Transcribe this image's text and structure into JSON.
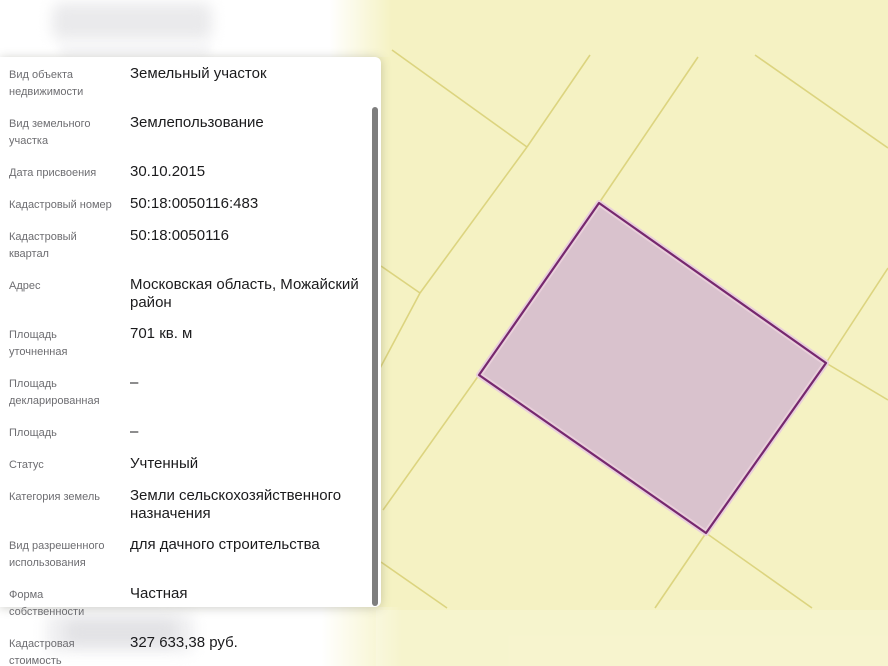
{
  "page": {
    "background": "#ffffff"
  },
  "panel": {
    "label_color": "#6d6d71",
    "value_color": "#1b1b1d",
    "rows": [
      {
        "label": "Вид объекта недвижимости",
        "value": "Земельный участок"
      },
      {
        "label": "Вид земельного участка",
        "value": "Землепользование"
      },
      {
        "label": "Дата присвоения",
        "value": "30.10.2015"
      },
      {
        "label": "Кадастровый номер",
        "value": "50:18:0050116:483"
      },
      {
        "label": "Кадастровый квартал",
        "value": "50:18:0050116"
      },
      {
        "label": "Адрес",
        "value": "Московская область, Можайский район"
      },
      {
        "label": "Площадь уточненная",
        "value": "701 кв. м"
      },
      {
        "label": "Площадь декларированная",
        "value": "–"
      },
      {
        "label": "Площадь",
        "value": "–"
      },
      {
        "label": "Статус",
        "value": "Учтенный"
      },
      {
        "label": "Категория земель",
        "value": "Земли сельскохозяйственного назначения"
      },
      {
        "label": "Вид разрешенного использования",
        "value": "для дачного строительства"
      },
      {
        "label": "Форма собственности",
        "value": "Частная"
      },
      {
        "label": "Кадастровая стоимость",
        "value": "327 633,38 руб."
      }
    ]
  },
  "map": {
    "width": 888,
    "height": 666,
    "background": "#f5f2c3",
    "line_color": "#d9d078",
    "parcel": {
      "fill": "#d9c2cd",
      "halo": "#e9cfdb",
      "stroke": "#76286e",
      "points": [
        [
          599,
          203
        ],
        [
          826,
          363
        ],
        [
          706,
          533
        ],
        [
          479,
          375
        ]
      ]
    },
    "lines": [
      [
        392,
        50,
        527,
        147
      ],
      [
        590,
        55,
        527,
        147
      ],
      [
        527,
        147,
        420,
        293
      ],
      [
        420,
        293,
        378,
        372
      ],
      [
        381,
        266,
        420,
        293
      ],
      [
        479,
        375,
        383,
        510
      ],
      [
        381,
        562,
        447,
        608
      ],
      [
        698,
        57,
        599,
        203
      ],
      [
        755,
        55,
        888,
        148
      ],
      [
        888,
        268,
        826,
        363
      ],
      [
        826,
        363,
        888,
        400
      ],
      [
        706,
        533,
        655,
        608
      ],
      [
        706,
        533,
        812,
        608
      ]
    ]
  },
  "scrollbar": {
    "color": "#7e7e7e"
  }
}
